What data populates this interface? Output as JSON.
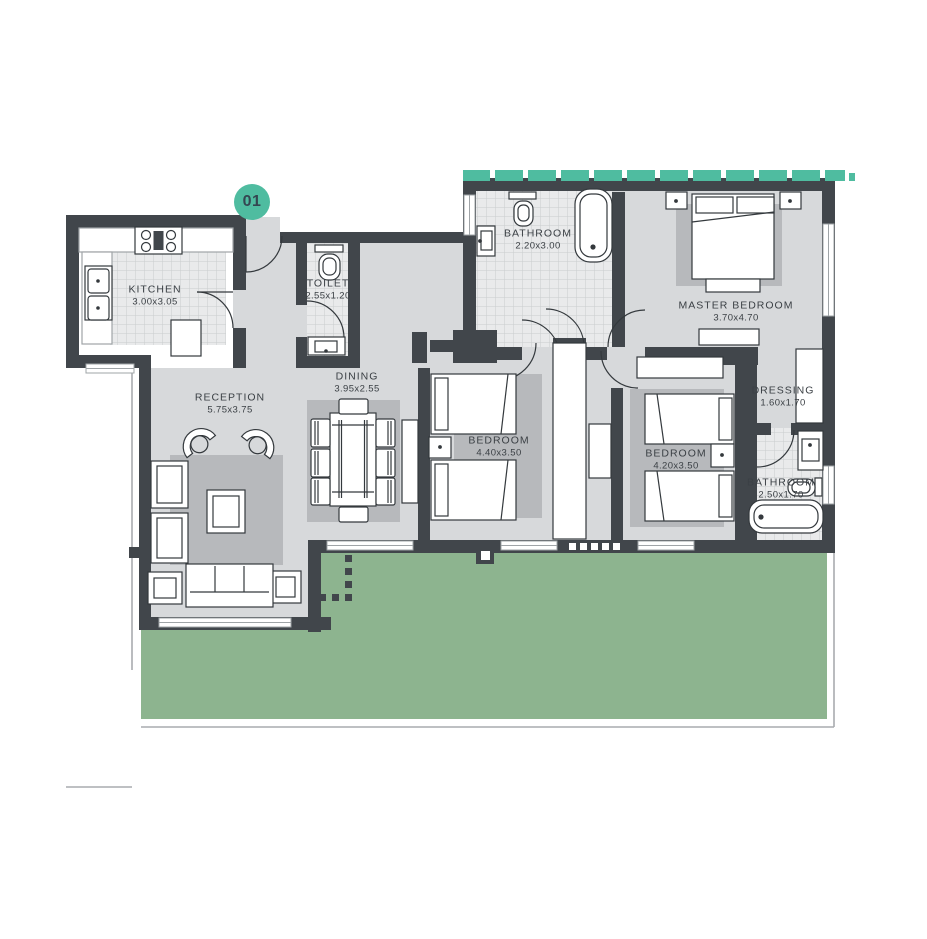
{
  "badge": {
    "label": "01"
  },
  "rooms": [
    {
      "id": "kitchen",
      "name": "KITCHEN",
      "dims": "3.00x3.05"
    },
    {
      "id": "toilet",
      "name": "TOILET",
      "dims": "2.55x1.20"
    },
    {
      "id": "bathroom",
      "name": "BATHROOM",
      "dims": "2.20x3.00"
    },
    {
      "id": "master-bedroom",
      "name": "MASTER BEDROOM",
      "dims": "3.70x4.70"
    },
    {
      "id": "reception",
      "name": "RECEPTION",
      "dims": "5.75x3.75"
    },
    {
      "id": "dining",
      "name": "DINING",
      "dims": "3.95x2.55"
    },
    {
      "id": "bedroom-1",
      "name": "BEDROOM",
      "dims": "4.40x3.50"
    },
    {
      "id": "bedroom-2",
      "name": "BEDROOM",
      "dims": "4.20x3.50"
    },
    {
      "id": "dressing",
      "name": "DRESSING",
      "dims": "1.60x1.70"
    },
    {
      "id": "bathroom-2",
      "name": "BATHROOM",
      "dims": "2.50x1.70"
    }
  ],
  "colors": {
    "accent_teal": "#4fbca0",
    "garden_green": "#8db48f",
    "wall_dark": "#41464b",
    "floor_light": "#d7d9db",
    "rug_gray": "#b7b9bc"
  }
}
